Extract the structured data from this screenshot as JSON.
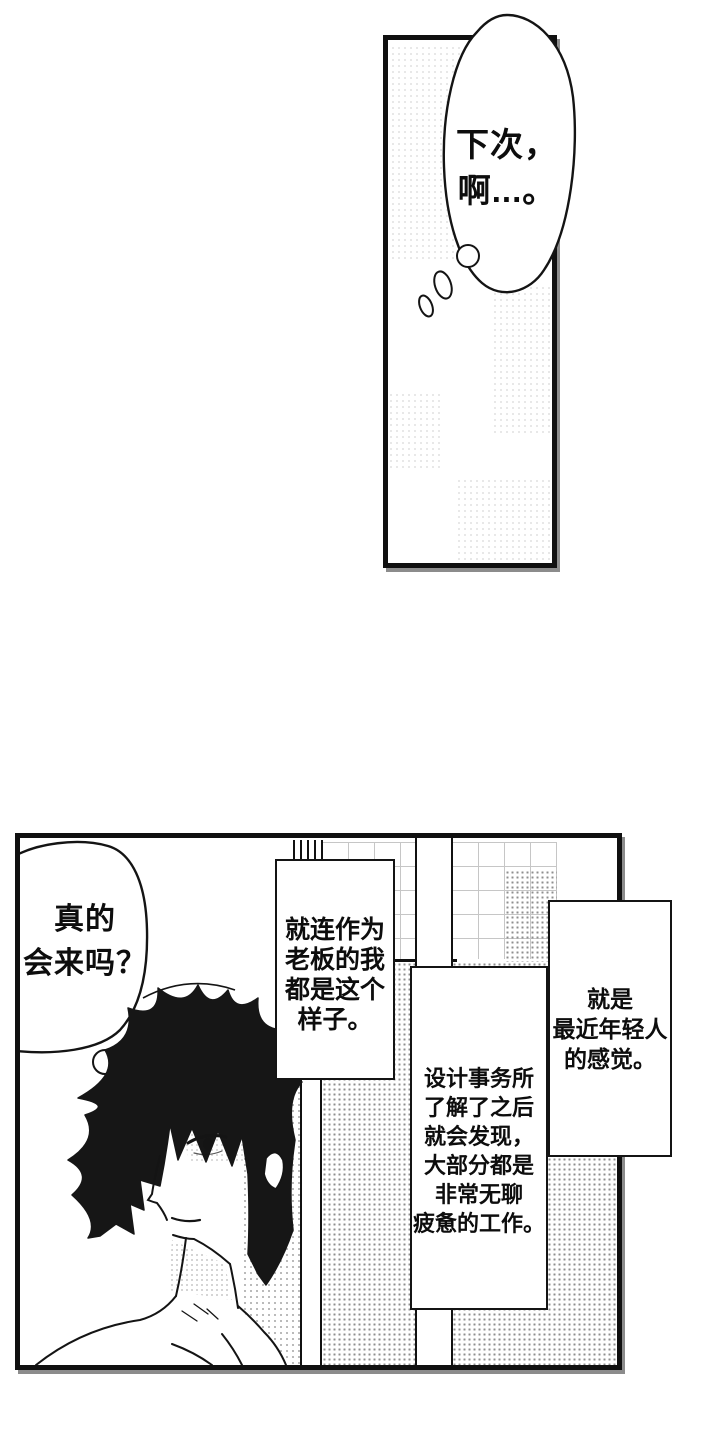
{
  "page": {
    "background": "#ffffff",
    "ink_color": "#111111",
    "type_label": "manga page"
  },
  "panel_top": {
    "thought_bubble": {
      "text": "下次，\n啊...。"
    }
  },
  "panel_bottom": {
    "thought_bubble": {
      "text": "真的\n会来吗？"
    },
    "caption_boxes": [
      {
        "id": "A",
        "text": "就连作为\n老板的我\n都是这个\n样子。"
      },
      {
        "id": "B",
        "text": "设计事务所\n了解了之后\n就会发现，\n大部分都是\n非常无聊\n疲惫的工作。"
      },
      {
        "id": "C",
        "text": "就是\n最近年轻人\n的感觉。"
      }
    ]
  }
}
